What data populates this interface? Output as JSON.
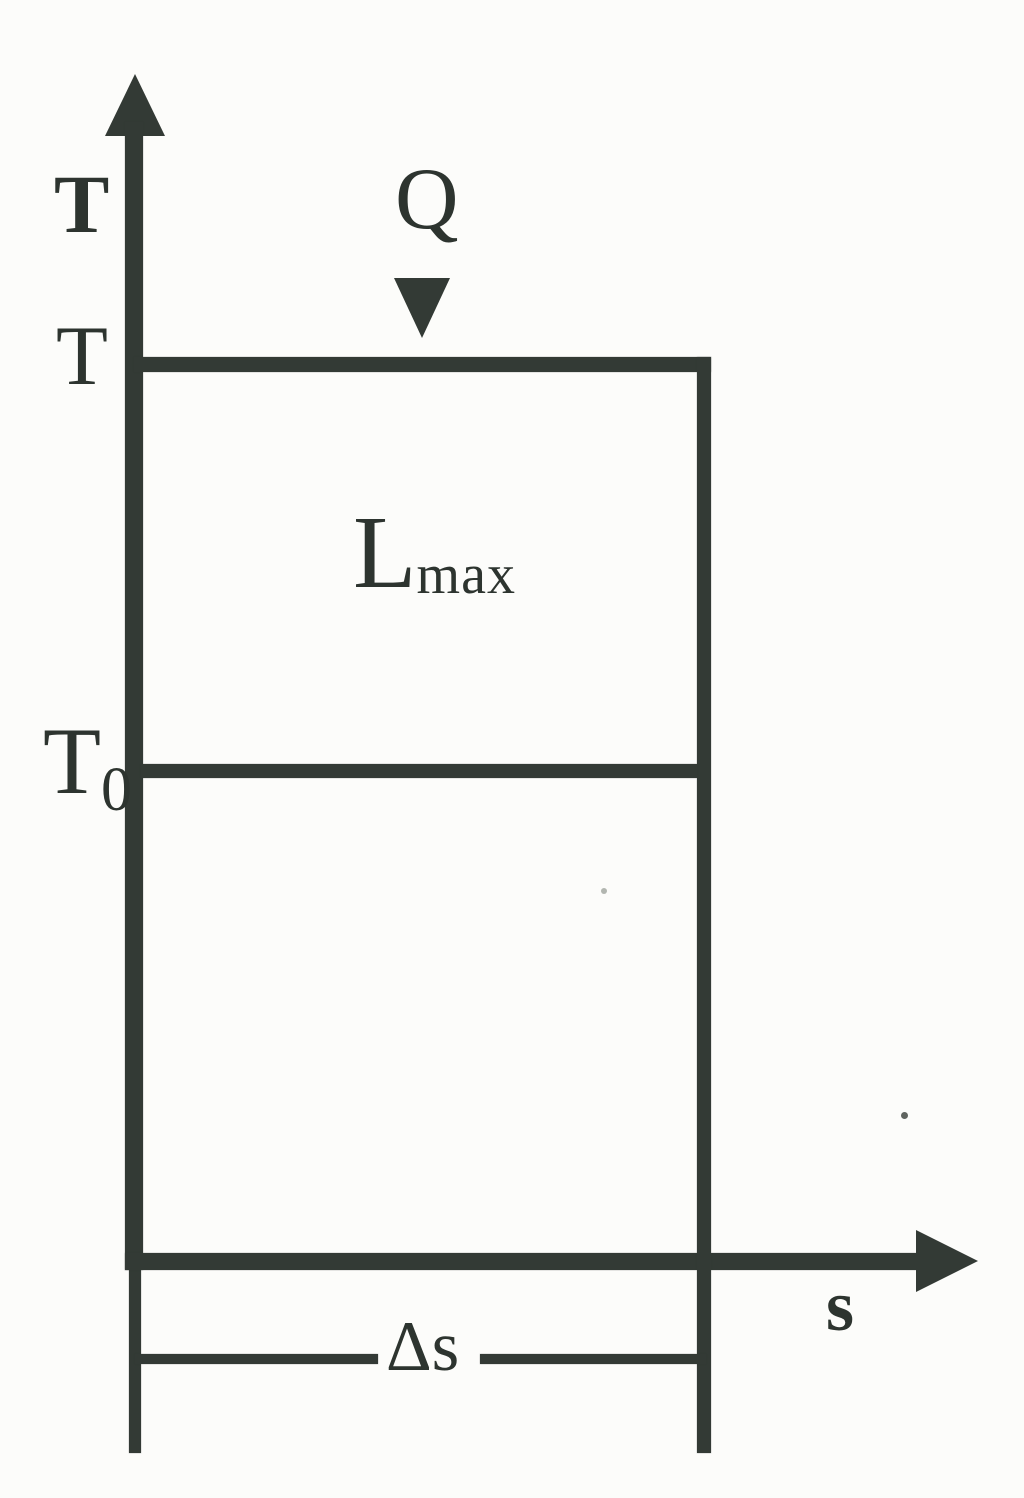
{
  "figure": {
    "labels": {
      "y_axis": "T",
      "x_axis": "s",
      "tick_top": "T",
      "tick_mid_base": "T",
      "tick_mid_sub": "0",
      "heat": "Q",
      "work_base": "L",
      "work_sub": "max",
      "delta_s": "Δs"
    },
    "colors": {
      "ink": "#333a35",
      "paper": "#fcfcfa"
    },
    "icons": {
      "y_axis_arrowhead": "triangle-up",
      "x_axis_arrowhead": "triangle-right",
      "heat_arrow": "triangle-down"
    }
  }
}
